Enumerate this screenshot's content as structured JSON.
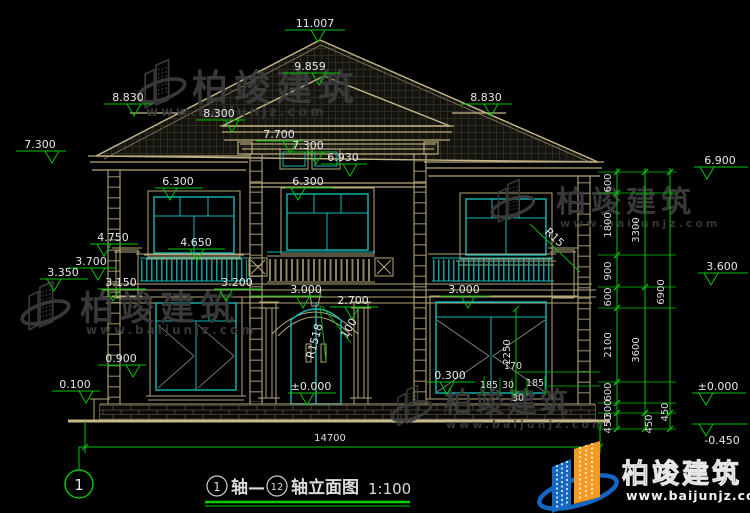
{
  "title": {
    "sheet_bubble": "1",
    "axis_from": "1",
    "axis_seg1": "轴—",
    "axis_to": "12",
    "axis_seg2": "轴立面图",
    "scale": "1:100"
  },
  "levels": {
    "ridge": "11.007",
    "tower_ridge": "9.859",
    "left_wing_ridge": "8.830",
    "right_wing_ridge": "8.830",
    "tower_eave": "8.300",
    "tower_parapet": "7.700",
    "left_eave": "7.300",
    "tower_window_head": "7.300",
    "tower_window_sill": "6.930",
    "right_eave": "6.900",
    "window2f_left_head": "6.300",
    "window2f_tower_head": "6.300",
    "pier_cap": "4.750",
    "balcony_rail": "4.650",
    "slab_top": "3.700",
    "slab_band": "3.350",
    "slab_bottom": "3.150",
    "center_rail": "3.200",
    "window1f_center_head": "3.000",
    "door_arch": "2.700",
    "window1f_right_head": "3.000",
    "floor2": "3.600",
    "window1f_sill": "0.900",
    "plinth_top": "0.100",
    "door_threshold": "±0.000",
    "window1f_right_sill": "0.300",
    "datum": "±0.000",
    "ground": "-0.450"
  },
  "dims": {
    "total_width": "14700",
    "col1": [
      "600",
      "1800",
      "900",
      "600",
      "2100",
      "600",
      "300",
      "450"
    ],
    "col2": [
      "3300",
      "3600",
      "450"
    ],
    "col3": [
      "6900",
      "450"
    ],
    "window_height": "2250",
    "detail": {
      "d170": "170",
      "d185a": "185",
      "d30a": "30",
      "d185b": "185",
      "d30b": "30"
    }
  },
  "annotations": {
    "door_radius": "R1518",
    "door_offset": "100",
    "balcony_radius": "R15"
  },
  "watermark": {
    "brand": "柏竣建筑",
    "site": "www.baijunjz.com"
  },
  "colors": {
    "line_tan": "#b6a87a",
    "accent_cyan": "#14b8b8",
    "dim_green": "#00c300",
    "text": "#e8e8e8",
    "logo_blue": "#1668c0",
    "logo_orange": "#f59b23"
  }
}
